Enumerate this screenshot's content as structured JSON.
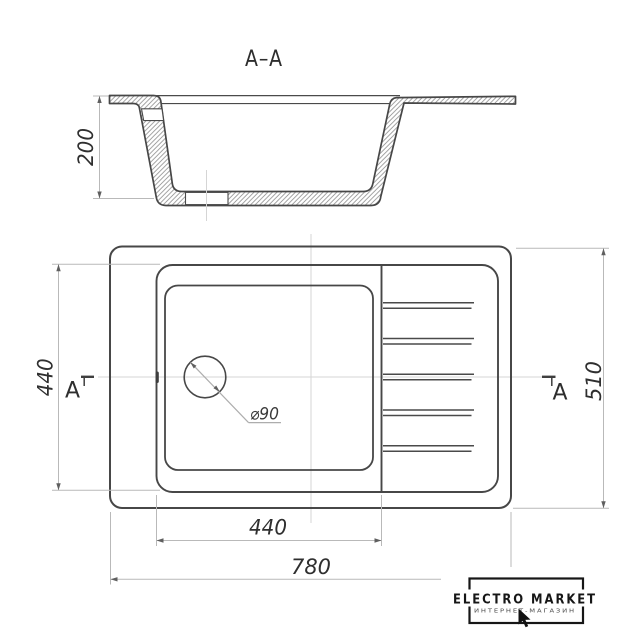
{
  "section": {
    "title": "A–A",
    "depth_label": "200",
    "depth_value_mm": 200
  },
  "plan": {
    "left_dim": "440",
    "right_dim": "510",
    "bottom_inner_dim": "440",
    "bottom_overall_dim": "780",
    "drain_label": "⌀90",
    "marker_left": "A",
    "marker_right": "A",
    "values_mm": {
      "overall_length": 780,
      "overall_depth": 510,
      "bowl_length": 440,
      "bowl_depth_span": 440,
      "drain_diameter": 90
    }
  },
  "logo": {
    "title": "ELECTRO MARKET",
    "subtitle": "ИНТЕРНЕТ-МАГАЗИН"
  },
  "colors": {
    "main_line": "#474747",
    "dim_line": "#b9b9b9",
    "centerline": "#d5d5d5",
    "hatch": "#8f8f8f",
    "text": "#2f2f2f",
    "logo": "#161616"
  }
}
